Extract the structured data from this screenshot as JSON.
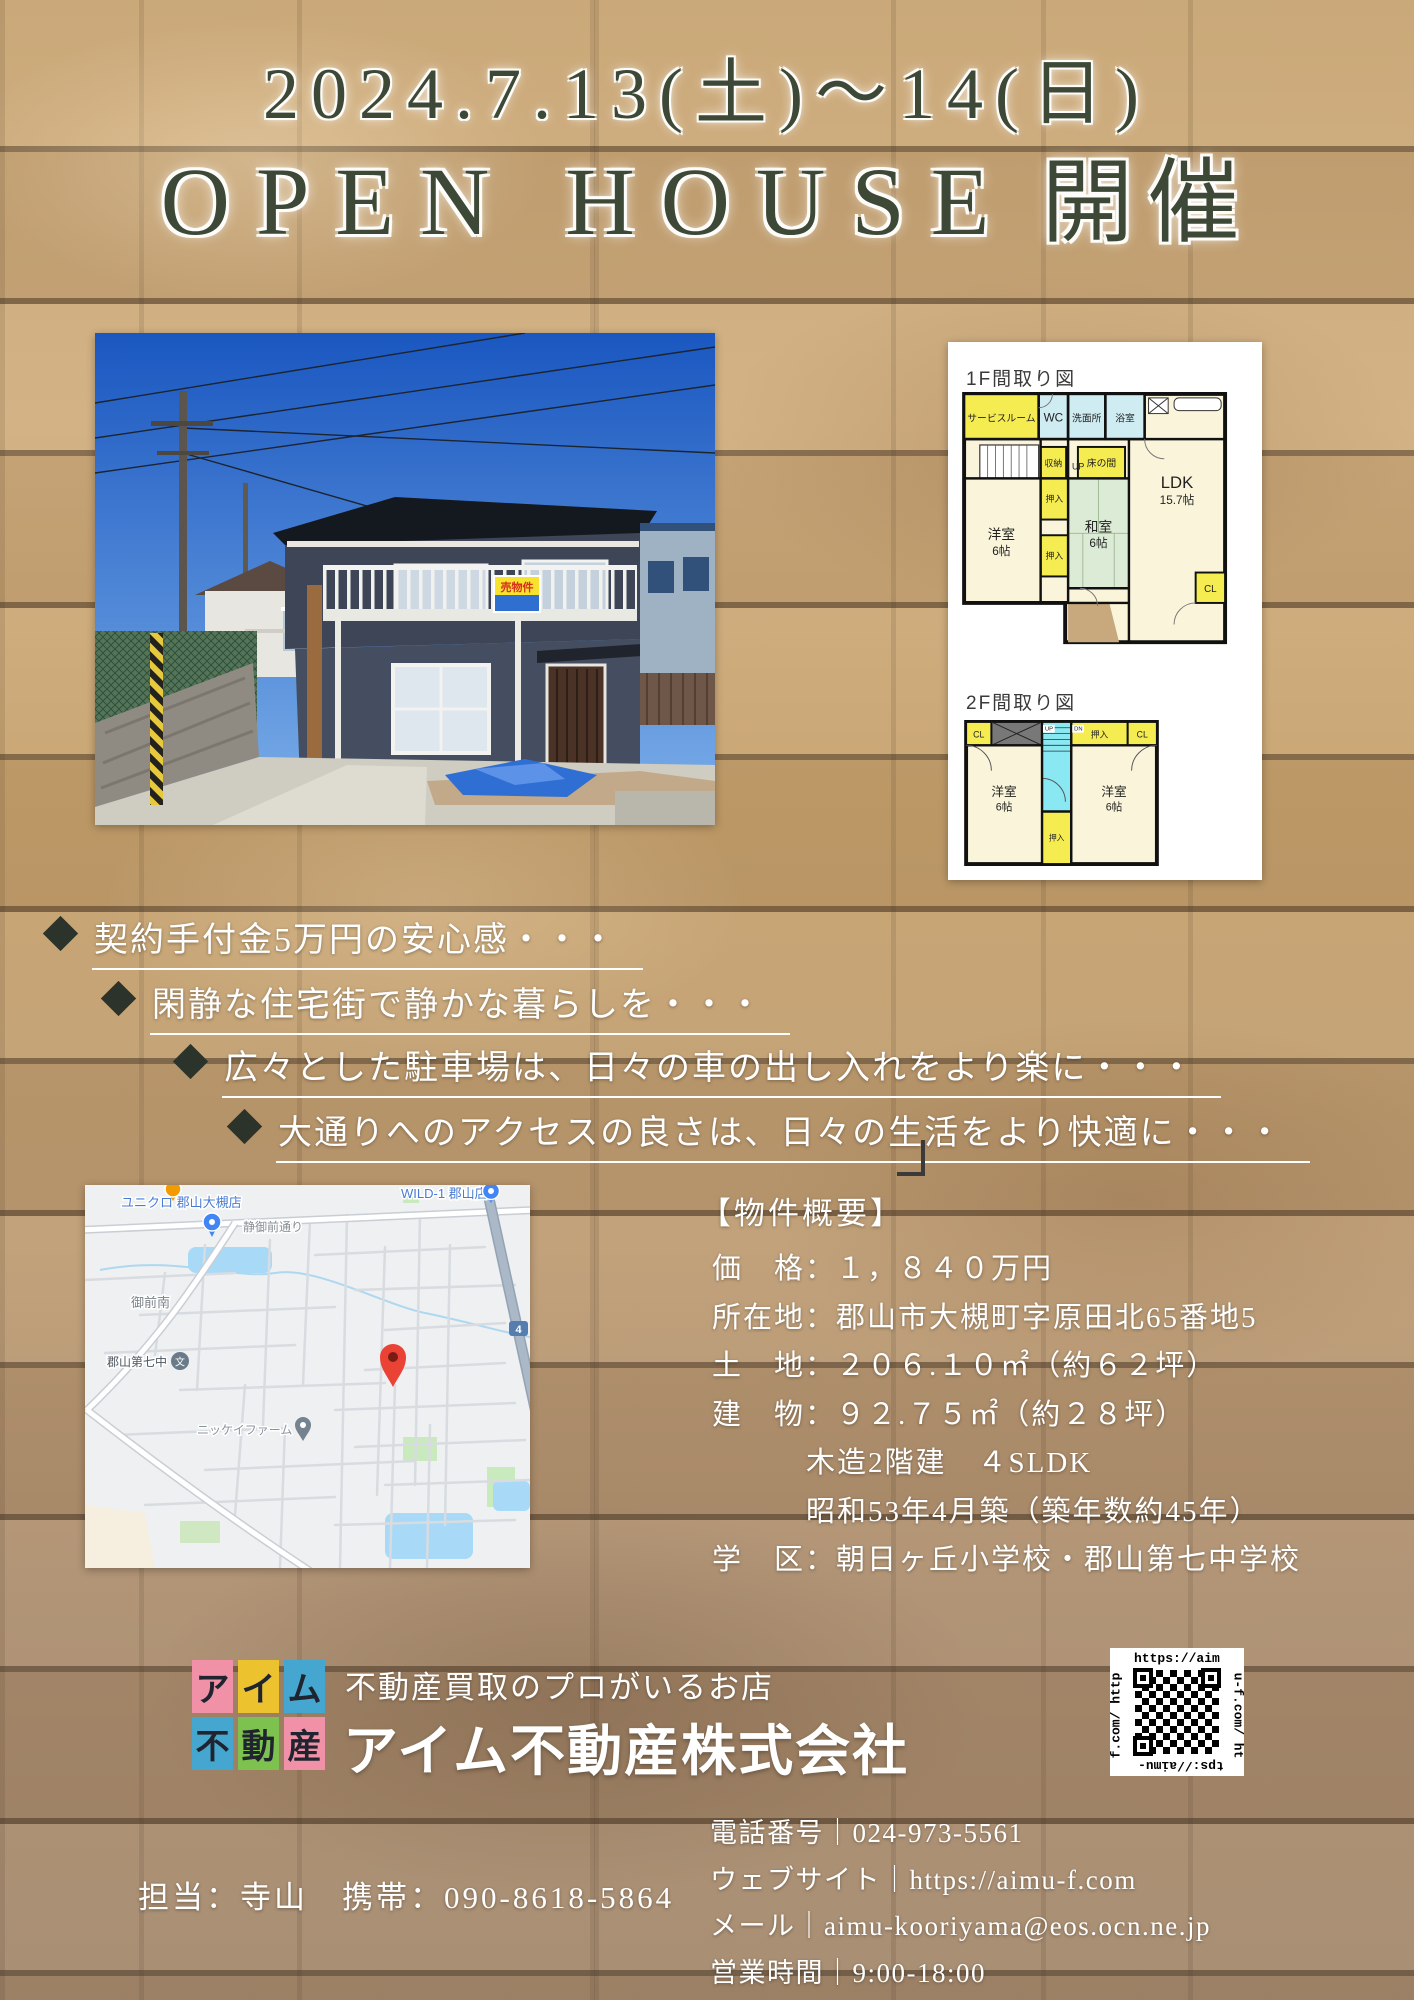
{
  "header": {
    "date": "2024.7.13(土)～14(日)",
    "title_en": "OPEN HOUSE",
    "title_ja": "開催"
  },
  "photo": {
    "sale_sign": "売物件",
    "window_sign_left": "売",
    "window_sign_right": "家"
  },
  "floorplan_1f": {
    "title": "1F間取り図",
    "service_room": "サービスルーム",
    "wc": "WC",
    "washroom": "洗面所",
    "bath": "浴室",
    "storage": "収納",
    "up": "UP",
    "tokonoma": "床の間",
    "oshiire": "押入",
    "western_room": "洋室",
    "western_room_size": "6帖",
    "japanese_room": "和室",
    "japanese_room_size": "6帖",
    "ldk": "LDK",
    "ldk_size": "15.7帖",
    "cl": "CL"
  },
  "floorplan_2f": {
    "title": "2F間取り図",
    "cl": "CL",
    "oshiire": "押入",
    "western_room": "洋室",
    "size": "6帖",
    "up": "UP",
    "dn": "DN"
  },
  "bullets": [
    {
      "text": "契約手付金5万円の安心感・・・"
    },
    {
      "text": "閑静な住宅街で静かな暮らしを・・・"
    },
    {
      "text": "広々とした駐車場は、日々の車の出し入れをより楽に・・・"
    },
    {
      "text": "大通りへのアクセスの良さは、日々の生活をより快適に・・・"
    }
  ],
  "map": {
    "poi_uniqlo": "ユニクロ 郡山大槻店",
    "street": "静御前通り",
    "poi_wild1": "WILD-1 郡山店",
    "area": "御前南",
    "school": "郡山第七中",
    "school_icon_glyph": "文",
    "farm": "ニッケイファーム",
    "route_shield": "4"
  },
  "property": {
    "heading": "【物件概要】",
    "lines": [
      "価　格：１，８４０万円",
      "所在地：郡山市大槻町字原田北65番地5",
      "土　地：２０６.１０㎡（約６２坪）",
      "建　物：９２.７５㎡（約２８坪）",
      "木造2階建　４SLDK",
      "昭和53年4月築（築年数約45年）",
      "学　区：朝日ヶ丘小学校・郡山第七中学校"
    ]
  },
  "company": {
    "logo_tiles": [
      "ア",
      "イ",
      "ム",
      "不",
      "動",
      "産"
    ],
    "tagline": "不動産買取のプロがいるお店",
    "name": "アイム不動産株式会社"
  },
  "qr": {
    "url": "https://aimu-f.com/",
    "side_top": "https://aim",
    "side_right": "u-f.com/ ht",
    "side_bottom": "tps://aimu-",
    "side_left": "f.com/ http"
  },
  "contact": {
    "staff": "担当：寺山　携帯：090-8618-5864",
    "rows": [
      "電話番号｜024-973-5561",
      "ウェブサイト｜https://aimu-f.com",
      "メール｜aimu-kooriyama@eos.ocn.ne.jp",
      "営業時間｜9:00-18:00"
    ]
  },
  "colors": {
    "header_text": "#3d4837",
    "logo_pink": "#f191a8",
    "logo_yellow": "#ecc32f",
    "logo_blue": "#45a7cf",
    "logo_green": "#7dc24e",
    "map_pin_red": "#ea4335",
    "plan_yellow": "#f5ec51",
    "plan_cream": "#faf5da",
    "plan_tatami": "#dcebd5",
    "plan_aqua": "#8ae8f2"
  }
}
